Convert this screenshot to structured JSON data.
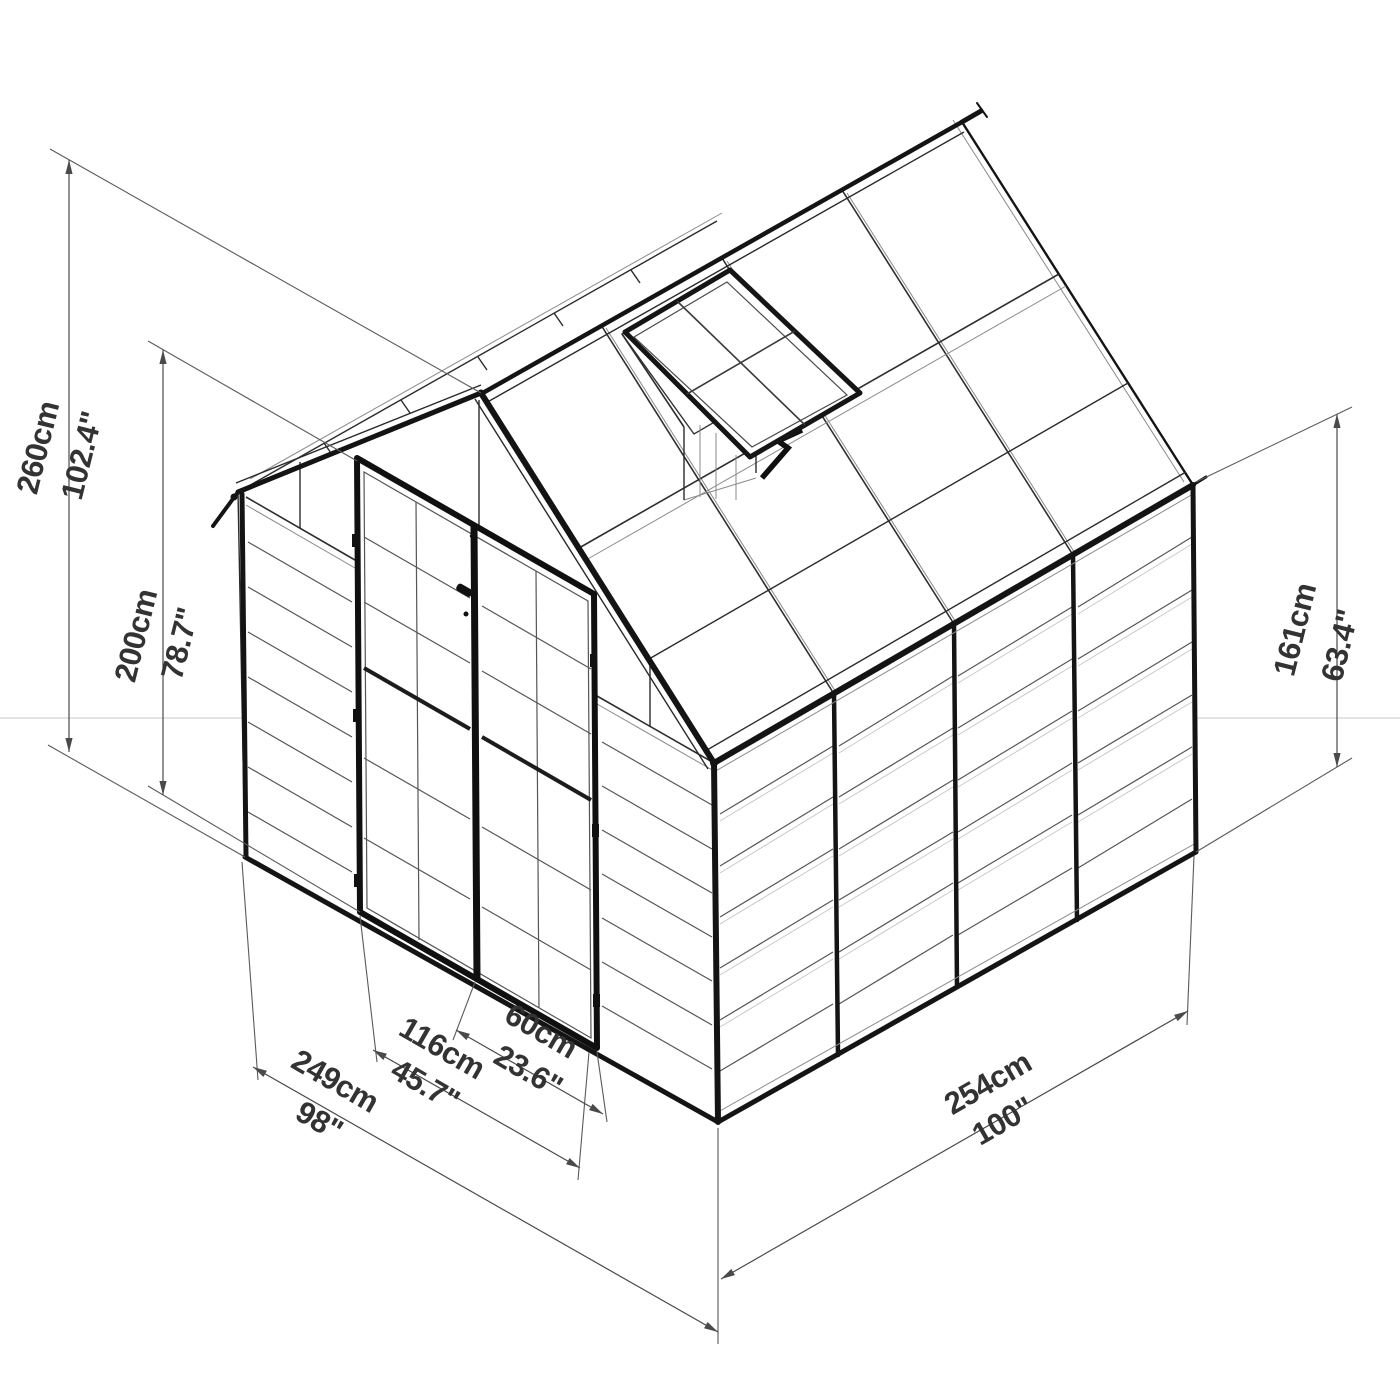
{
  "drawing": {
    "subject": "greenhouse-isometric-dimension-drawing",
    "background": "#ffffff",
    "line_color": "#2a2a2a",
    "frame_color": "#141414",
    "dimension_line_color": "#4a4a4a",
    "text_color": "#333333"
  },
  "dimensions": {
    "total_height": {
      "cm": "260cm",
      "in": "102.4\""
    },
    "door_height": {
      "cm": "200cm",
      "in": "78.7\""
    },
    "side_wall_height": {
      "cm": "161cm",
      "in": "63.4\""
    },
    "front_width": {
      "cm": "249cm",
      "in": "98\""
    },
    "double_door_width": {
      "cm": "116cm",
      "in": "45.7\""
    },
    "single_door_width": {
      "cm": "60cm",
      "in": "23.6\""
    },
    "side_depth": {
      "cm": "254cm",
      "in": "100\""
    }
  }
}
